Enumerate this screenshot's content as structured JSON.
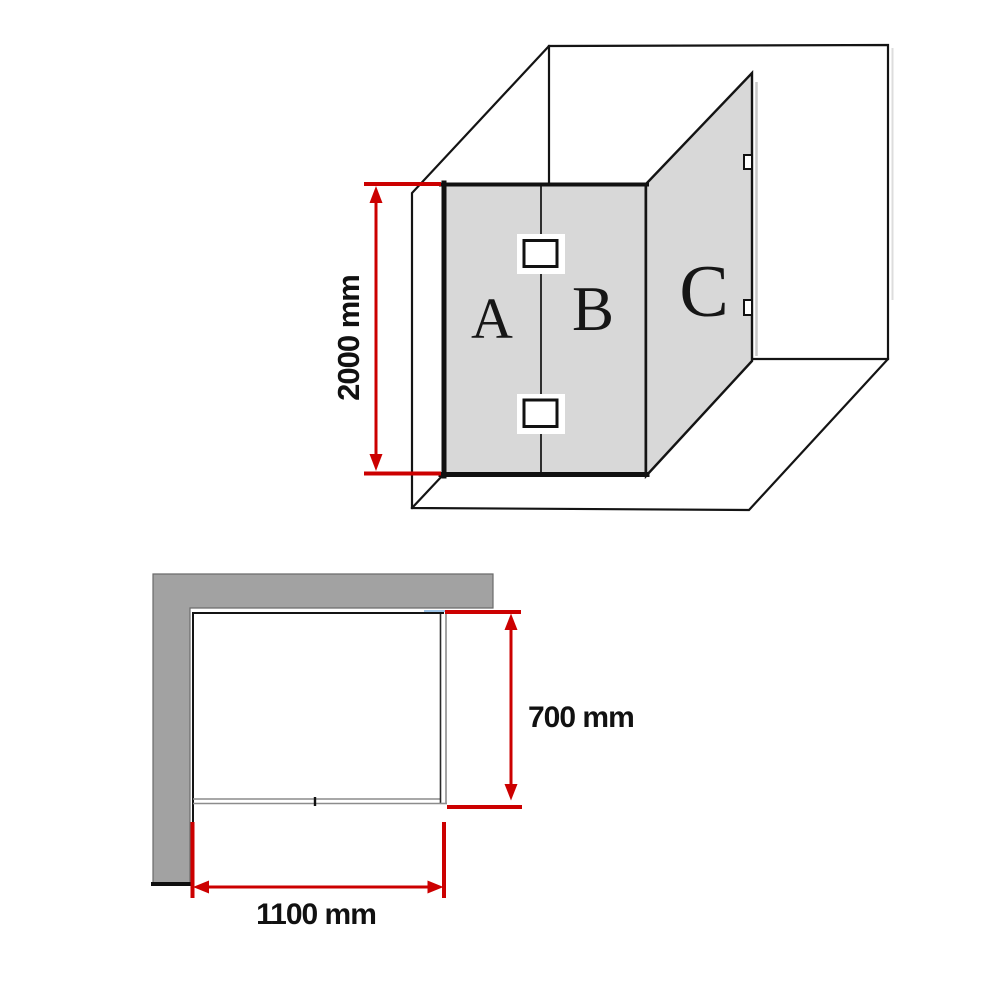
{
  "diagram": {
    "kind": "shower-screen-dimension-drawing",
    "panels": [
      {
        "id": "A",
        "position": "front-left-fixed"
      },
      {
        "id": "B",
        "position": "front-right"
      },
      {
        "id": "C",
        "position": "side-return"
      }
    ]
  },
  "labels": {
    "panel_a": "A",
    "panel_b": "B",
    "panel_c": "C"
  },
  "dimensions": {
    "height": "2000 mm",
    "depth": "700 mm",
    "width": "1100 mm"
  },
  "colors": {
    "glass_fill": "#d8d8d8",
    "wall_fill": "#a2a2a2",
    "outline": "#141414",
    "dimension_red": "#cc0000",
    "plan_glass_gray": "#8c8c8c",
    "plan_glass_hint_blue": "#9dc3e6",
    "background": "#ffffff"
  }
}
